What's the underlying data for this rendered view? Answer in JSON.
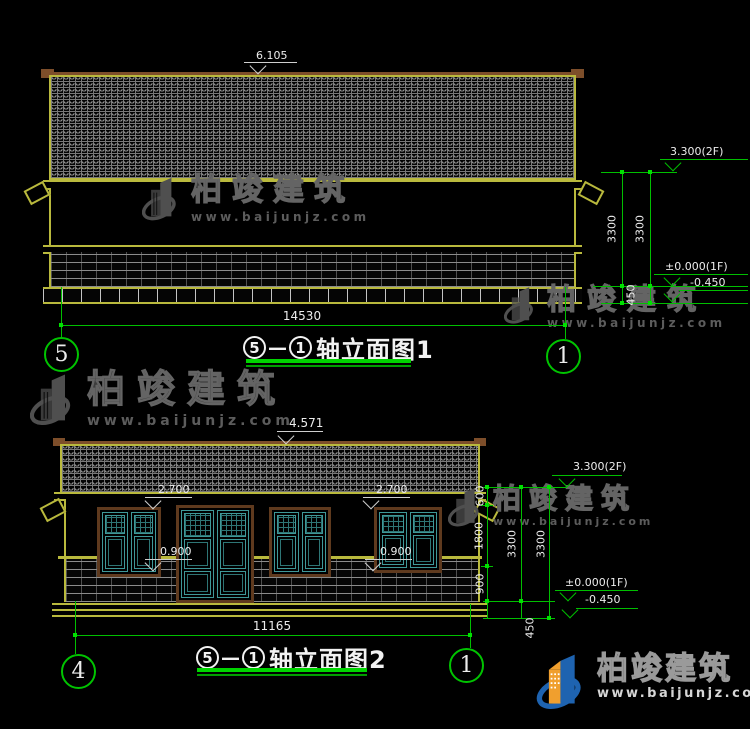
{
  "watermark": {
    "brand": "柏竣建筑",
    "url": "www.baijunjz.com"
  },
  "footer_logo": {
    "brand": "柏竣建筑",
    "url": "www.baijunjz.com"
  },
  "colors": {
    "outline_yellow": "#b9b93d",
    "dimension_green": "#00bf00",
    "text_white": "#ececec",
    "window_teal": "#3f9898",
    "frame_brown": "#5f3a1e",
    "eave_brown": "#7d4e2a",
    "watermark_gray": "#4f4f4f",
    "logo_blue": "#1e63b0",
    "logo_orange": "#f09f2e"
  },
  "elevation1": {
    "levels": {
      "ridge": "6.105",
      "f2": "3.300(2F)",
      "f1": "±0.000(1F)",
      "ground": "-0.450"
    },
    "dims": {
      "h_upper": "3300",
      "h_lower": "3300",
      "plinth": "450",
      "width": "14530"
    },
    "title": {
      "from": "5",
      "dash": "—",
      "to": "1",
      "label": "轴立面图1"
    },
    "axes": {
      "left": "5",
      "right": "1"
    }
  },
  "elevation2": {
    "levels": {
      "ridge": "4.571",
      "f2": "3.300(2F)",
      "f1": "±0.000(1F)",
      "ground": "-0.450",
      "lintel_left": "2.700",
      "lintel_right": "2.700",
      "sill_left": "0.900",
      "sill_right": "0.900"
    },
    "dims": {
      "eave_to_lintel": "600",
      "window_height": "1800",
      "sill_height": "900",
      "h_a": "3300",
      "h_b": "3300",
      "plinth": "450",
      "width": "11165"
    },
    "title": {
      "from": "5",
      "dash": "—",
      "to": "1",
      "label": "轴立面图2"
    },
    "axes": {
      "left": "4",
      "right": "1"
    }
  }
}
